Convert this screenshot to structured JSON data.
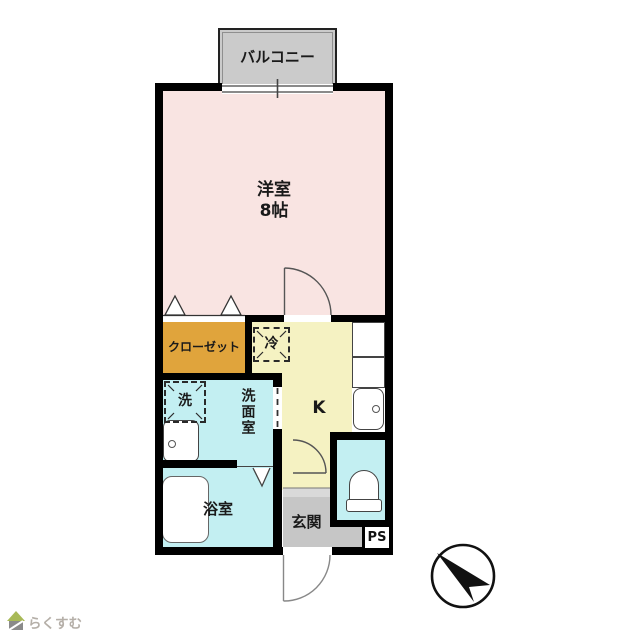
{
  "floorplan": {
    "labels": {
      "balcony": "バルコニー",
      "main_room": "洋室",
      "main_room_size": "8帖",
      "closet": "クローゼット",
      "fridge": "冷",
      "washer": "洗",
      "washroom": "洗面室",
      "kitchen": "K",
      "bath": "浴室",
      "entrance": "玄関",
      "pipe_space": "PS"
    },
    "colors": {
      "main_room": "#f9e4e2",
      "kitchen": "#f5f2c2",
      "wet_area": "#c3eff2",
      "closet": "#e0a43c",
      "entrance": "#c6c6c6",
      "entrance_step": "#d9d9d9",
      "balcony": "#cbcbcb",
      "wall": "#000000"
    }
  },
  "compass": {
    "type": "north-arrow",
    "direction": "northwest"
  },
  "logo": {
    "text": "らくすむ"
  }
}
